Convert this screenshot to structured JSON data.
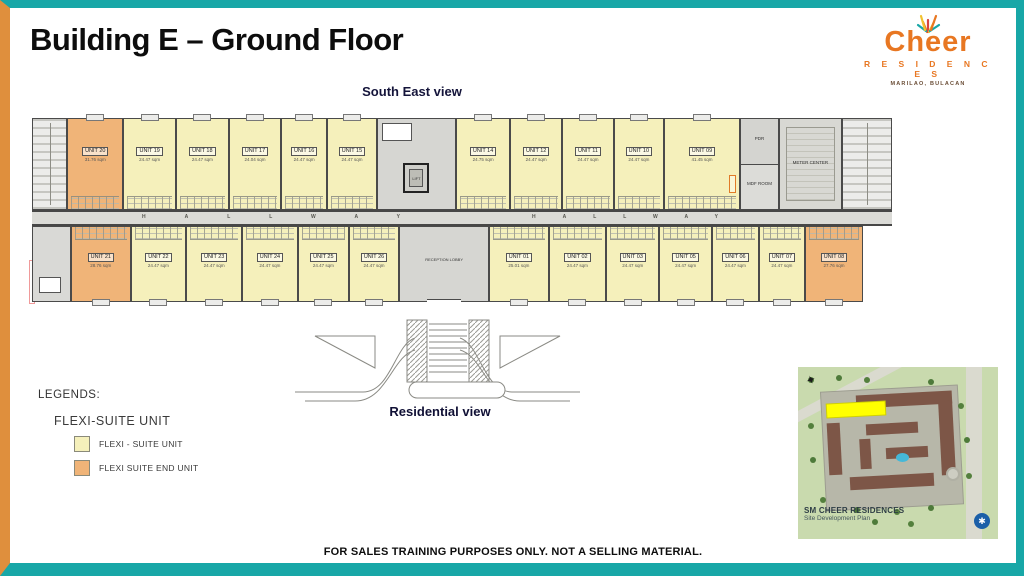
{
  "slide": {
    "title": "Building E – Ground Floor",
    "view_top_label": "South East view",
    "view_bottom_label": "Residential view",
    "disclaimer": "FOR SALES TRAINING PURPOSES ONLY. NOT A SELLING MATERIAL."
  },
  "logo": {
    "word": "Cheer",
    "subtitle": "R E S I D E N C E S",
    "location": "MARILAO, BULACAN",
    "burst_icon": "spark-burst-icon"
  },
  "floorplan": {
    "hallway_label": "HALLWAY",
    "top_row": [
      {
        "id": "UNIT 20",
        "area": "31.76 sqm",
        "type": "flexi-suite-end-unit"
      },
      {
        "id": "UNIT 19",
        "area": "24.47 sqm",
        "type": "flexi-suite-unit"
      },
      {
        "id": "UNIT 18",
        "area": "24.47 sqm",
        "type": "flexi-suite-unit"
      },
      {
        "id": "UNIT 17",
        "area": "24.04 sqm",
        "type": "flexi-suite-unit"
      },
      {
        "id": "UNIT 16",
        "area": "24.47 sqm",
        "type": "flexi-suite-unit"
      },
      {
        "id": "UNIT 15",
        "area": "24.47 sqm",
        "type": "flexi-suite-unit"
      },
      {
        "id": "UNIT 14",
        "area": "24.75 sqm",
        "type": "flexi-suite-unit"
      },
      {
        "id": "UNIT 12",
        "area": "24.47 sqm",
        "type": "flexi-suite-unit"
      },
      {
        "id": "UNIT 11",
        "area": "24.47 sqm",
        "type": "flexi-suite-unit"
      },
      {
        "id": "UNIT 10",
        "area": "24.47 sqm",
        "type": "flexi-suite-unit"
      },
      {
        "id": "UNIT 09",
        "area": "41.45 sqm",
        "type": "flexi-suite-unit"
      }
    ],
    "bottom_row": [
      {
        "id": "UNIT 21",
        "area": "28.76 sqm",
        "type": "flexi-suite-end-unit"
      },
      {
        "id": "UNIT 22",
        "area": "24.47 sqm",
        "type": "flexi-suite-unit"
      },
      {
        "id": "UNIT 23",
        "area": "24.47 sqm",
        "type": "flexi-suite-unit"
      },
      {
        "id": "UNIT 24",
        "area": "24.47 sqm",
        "type": "flexi-suite-unit"
      },
      {
        "id": "UNIT 25",
        "area": "24.47 sqm",
        "type": "flexi-suite-unit"
      },
      {
        "id": "UNIT 26",
        "area": "24.47 sqm",
        "type": "flexi-suite-unit"
      },
      {
        "id": "UNIT 01",
        "area": "25.01 sqm",
        "type": "flexi-suite-unit"
      },
      {
        "id": "UNIT 02",
        "area": "24.47 sqm",
        "type": "flexi-suite-unit"
      },
      {
        "id": "UNIT 03",
        "area": "24.47 sqm",
        "type": "flexi-suite-unit"
      },
      {
        "id": "UNIT 05",
        "area": "24.47 sqm",
        "type": "flexi-suite-unit"
      },
      {
        "id": "UNIT 06",
        "area": "24.47 sqm",
        "type": "flexi-suite-unit"
      },
      {
        "id": "UNIT 07",
        "area": "24.47 sqm",
        "type": "flexi-suite-unit"
      },
      {
        "id": "UNIT 08",
        "area": "27.76 sqm",
        "type": "flexi-suite-end-unit"
      }
    ],
    "rooms": {
      "pdr": "PDR",
      "mdf": "MDF ROOM",
      "meter": "METER CENTER",
      "lift": "LIFT",
      "reception": "RECEPTION LOBBY"
    }
  },
  "legend": {
    "heading": "LEGENDS:",
    "subheading": "FLEXI-SUITE UNIT",
    "items": [
      {
        "label": "FLEXI - SUITE UNIT",
        "color": "#f5f0bb"
      },
      {
        "label": "FLEXI SUITE END UNIT",
        "color": "#f0b478"
      }
    ]
  },
  "siteplan": {
    "title": "SM CHEER RESIDENCES",
    "subtitle": "Site Development Plan",
    "highlight": "building-e-location",
    "highlight_color": "#ffff00"
  },
  "colors": {
    "frame_teal": "#18a7a7",
    "frame_orange": "#df8f3d",
    "logo_orange": "#e87722",
    "unit_yellow": "#f5f0bb",
    "unit_end_orange": "#f0b478",
    "hallway_grey": "#dbdbd7"
  }
}
